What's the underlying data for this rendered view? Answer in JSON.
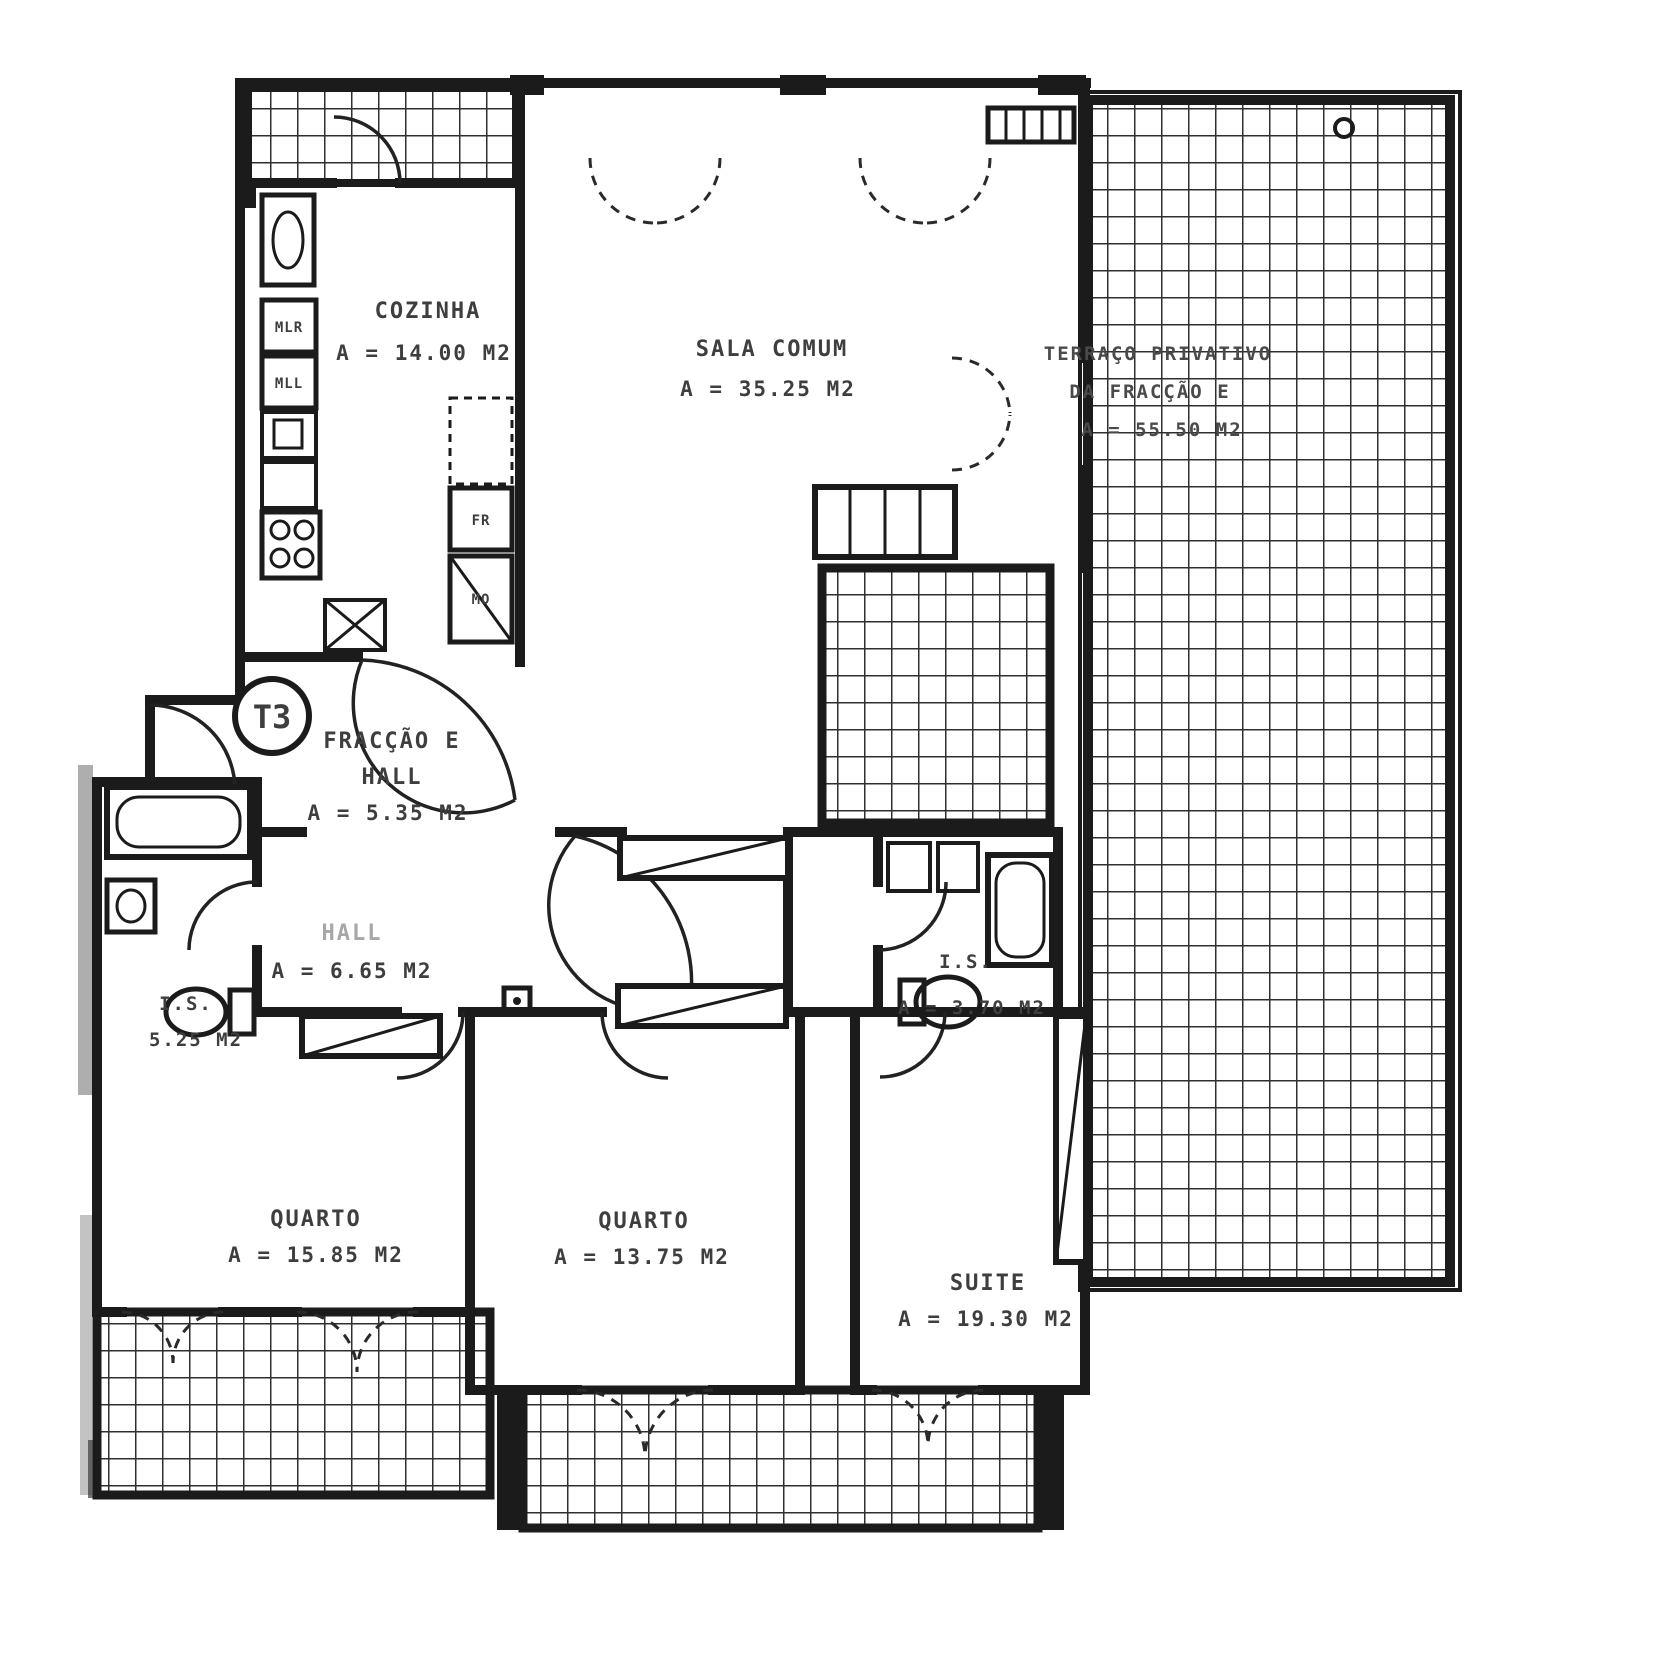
{
  "plan": {
    "badge": "T3",
    "rooms": {
      "cozinha": {
        "name": "COZINHA",
        "area": "A = 14.00 M2"
      },
      "sala": {
        "name": "SALA COMUM",
        "area": "A = 35.25 M2"
      },
      "terraco": {
        "line1": "TERRAÇO PRIVATIVO",
        "line2": "DA FRACÇÃO E",
        "area": "A = 55.50 M2"
      },
      "entrada": {
        "line1": "FRACÇÃO E",
        "line2": "HALL",
        "area": "A = 5.35 M2"
      },
      "hall": {
        "name": "HALL",
        "area": "A = 6.65 M2"
      },
      "is_esq": {
        "name": "I.S.",
        "area": "5.25 M2"
      },
      "is_dir": {
        "name": "I.S.",
        "area": "A = 3.70 M2"
      },
      "quarto_esq": {
        "name": "QUARTO",
        "area": "A = 15.85 M2"
      },
      "quarto_centro": {
        "name": "QUARTO",
        "area": "A = 13.75 M2"
      },
      "suite": {
        "name": "SUITE",
        "area": "A = 19.30 M2"
      }
    },
    "fixtures": {
      "mlr": "MLR",
      "mll": "MLL",
      "fr": "FR",
      "mo": "MO"
    },
    "colors": {
      "ink": "#1b1b1b",
      "label_gray": "#3e3e3e",
      "paper": "#ffffff"
    }
  }
}
